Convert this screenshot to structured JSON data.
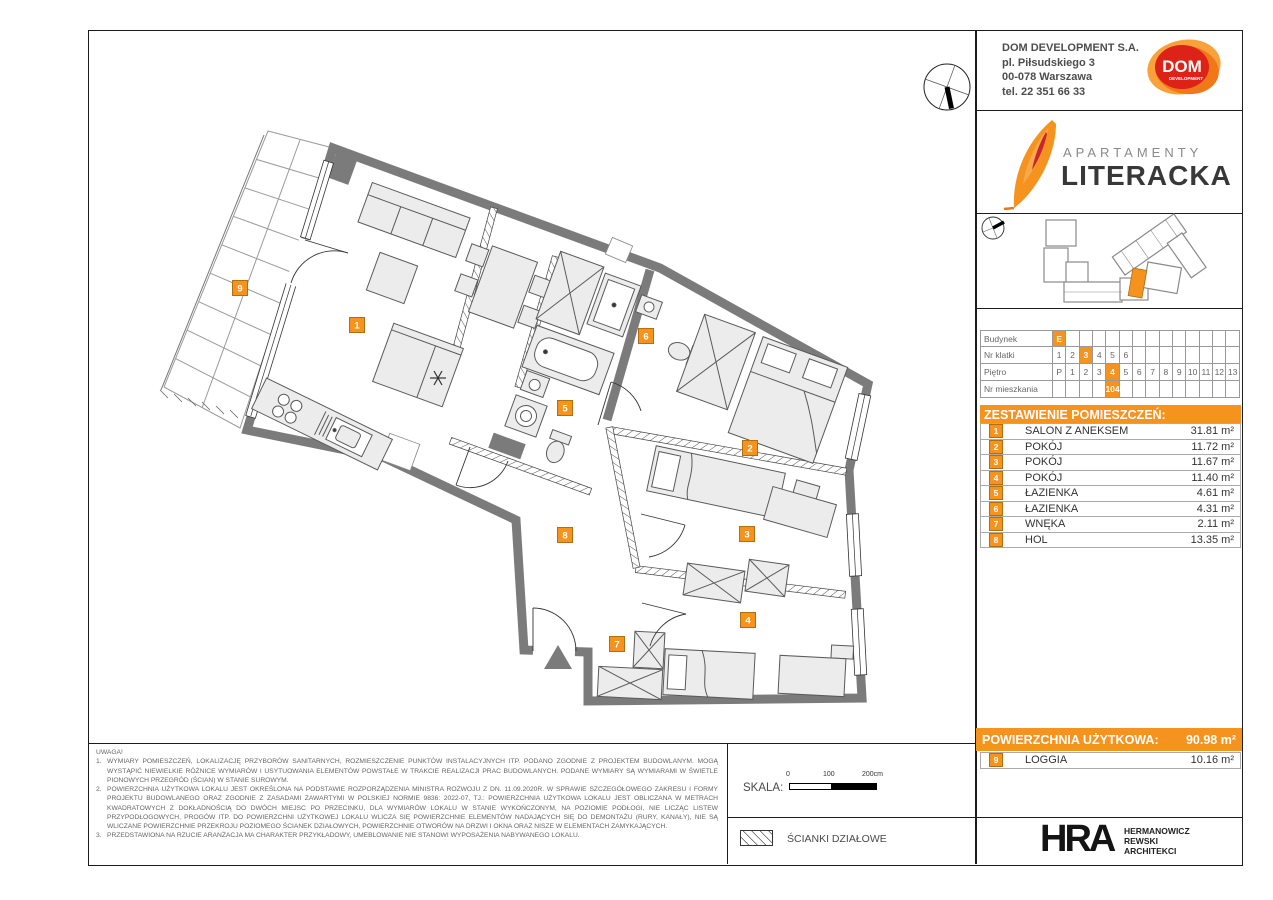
{
  "header": {
    "company": {
      "name": "DOM DEVELOPMENT S.A.",
      "address1": "pl. Piłsudskiego 3",
      "address2": "00-078 Warszawa",
      "phone": "tel. 22 351 66 33"
    },
    "dom_logo": {
      "text": "DOM",
      "sub": "DEVELOPMENT"
    },
    "brand": {
      "line1": "APARTAMENTY",
      "line2": "LITERACKA"
    }
  },
  "unit_table": {
    "rows": [
      {
        "label": "Budynek",
        "cells": [
          "E",
          "",
          "",
          "",
          "",
          "",
          "",
          "",
          "",
          "",
          "",
          "",
          "",
          ""
        ],
        "highlight": 0
      },
      {
        "label": "Nr klatki",
        "cells": [
          "1",
          "2",
          "3",
          "4",
          "5",
          "6",
          "",
          "",
          "",
          "",
          "",
          "",
          "",
          ""
        ],
        "highlight": 2
      },
      {
        "label": "Piętro",
        "cells": [
          "P",
          "1",
          "2",
          "3",
          "4",
          "5",
          "6",
          "7",
          "8",
          "9",
          "10",
          "11",
          "12",
          "13"
        ],
        "highlight": 4
      },
      {
        "label": "Nr mieszkania",
        "cells": [
          "",
          "",
          "",
          "",
          "104",
          "",
          "",
          "",
          "",
          "",
          "",
          "",
          "",
          ""
        ],
        "highlight": 4
      }
    ]
  },
  "rooms": {
    "title": "ZESTAWIENIE POMIESZCZEŃ:",
    "items": [
      {
        "num": "1",
        "name": "SALON Z ANEKSEM",
        "area": "31.81 m²"
      },
      {
        "num": "2",
        "name": "POKÓJ",
        "area": "11.72 m²"
      },
      {
        "num": "3",
        "name": "POKÓJ",
        "area": "11.67 m²"
      },
      {
        "num": "4",
        "name": "POKÓJ",
        "area": "11.40 m²"
      },
      {
        "num": "5",
        "name": "ŁAZIENKA",
        "area": "4.61 m²"
      },
      {
        "num": "6",
        "name": "ŁAZIENKA",
        "area": "4.31 m²"
      },
      {
        "num": "7",
        "name": "WNĘKA",
        "area": "2.11 m²"
      },
      {
        "num": "8",
        "name": "HOL",
        "area": "13.35 m²"
      }
    ]
  },
  "summary": {
    "label": "POWIERZCHNIA UŻYTKOWA:",
    "value": "90.98 m²",
    "loggia": {
      "num": "9",
      "name": "LOGGIA",
      "area": "10.16 m²"
    }
  },
  "notes": {
    "title": "UWAGA!",
    "items": [
      "WYMIARY POMIESZCZEŃ, LOKALIZACJĘ PRZYBORÓW SANITARNYCH, ROZMIESZCZENIE PUNKTÓW INSTALACYJNYCH ITP. PODANO ZGODNIE Z PROJEKTEM BUDOWLANYM. MOGĄ WYSTĄPIĆ NIEWIELKIE RÓŻNICE WYMIARÓW I USYTUOWANIA ELEMENTÓW POWSTAŁE W TRAKCIE REALIZACJI PRAC BUDOWLANYCH. PODANE WYMIARY SĄ WYMIARAMI W ŚWIETLE PIONOWYCH PRZEGRÓD (ŚCIAN) W STANIE SUROWYM.",
      "POWIERZCHNIA UŻYTKOWA LOKALU JEST OKREŚLONA NA PODSTAWIE ROZPORZĄDZENIA MINISTRA ROZWOJU Z DN. 11.09.2020R. W SPRAWIE SZCZEGÓŁOWEGO ZAKRESU I FORMY PROJEKTU BUDOWLANEGO ORAZ ZGODNIE Z ZASADAMI ZAWARTYMI W POLSKIEJ NORMIE 9836: 2022-07, TJ.: POWIERZCHNIA UŻYTKOWA LOKALU JEST OBLICZANA W METRACH KWADRATOWYCH Z DOKŁADNOŚCIĄ DO DWÓCH MIEJSC PO PRZECINKU, DLA WYMIARÓW LOKALU W STANIE WYKOŃCZONYM, NA POZIOMIE PODŁOGI, NIE LICZĄC LISTEW PRZYPODŁOGOWYCH, PROGÓW ITP. DO POWIERZCHNI UŻYTKOWEJ LOKALU WLICZA SIĘ POWIERZCHNIE ELEMENTÓW NADAJĄCYCH SIĘ DO DEMONTAŻU (RURY, KANAŁY), NIE SĄ WLICZANE POWIERZCHNIE PRZEKROJU POZIOMEGO ŚCIANEK DZIAŁOWYCH, POWIERZCHNIE OTWORÓW NA DRZWI I OKNA ORAZ NISZE W ELEMENTACH ZAMYKAJĄCYCH.",
      "PRZEDSTAWIONA NA RZUCIE ARANŻACJA MA CHARAKTER PRZYKŁADOWY, UMEBLOWANIE NIE STANOWI WYPOSAŻENIA NABYWANEGO LOKALU."
    ]
  },
  "scale": {
    "label": "SKALA:",
    "tick0": "0",
    "tick100": "100",
    "tick200": "200cm"
  },
  "legend": {
    "partition": "ŚCIANKI DZIAŁOWE"
  },
  "architect": {
    "abbr": "HRA",
    "lines": [
      "HERMANOWICZ",
      "REWSKI",
      "ARCHITEKCI"
    ]
  },
  "plan": {
    "room_badges": [
      {
        "num": "1",
        "x": 357,
        "y": 325
      },
      {
        "num": "2",
        "x": 750,
        "y": 448
      },
      {
        "num": "3",
        "x": 747,
        "y": 534
      },
      {
        "num": "4",
        "x": 748,
        "y": 620
      },
      {
        "num": "5",
        "x": 565,
        "y": 408
      },
      {
        "num": "6",
        "x": 646,
        "y": 336
      },
      {
        "num": "7",
        "x": 617,
        "y": 644
      },
      {
        "num": "8",
        "x": 565,
        "y": 535
      },
      {
        "num": "9",
        "x": 240,
        "y": 288
      }
    ]
  },
  "colors": {
    "accent": "#F6921E",
    "badge_border": "#B06F10",
    "wall": "#7b7b7b"
  }
}
